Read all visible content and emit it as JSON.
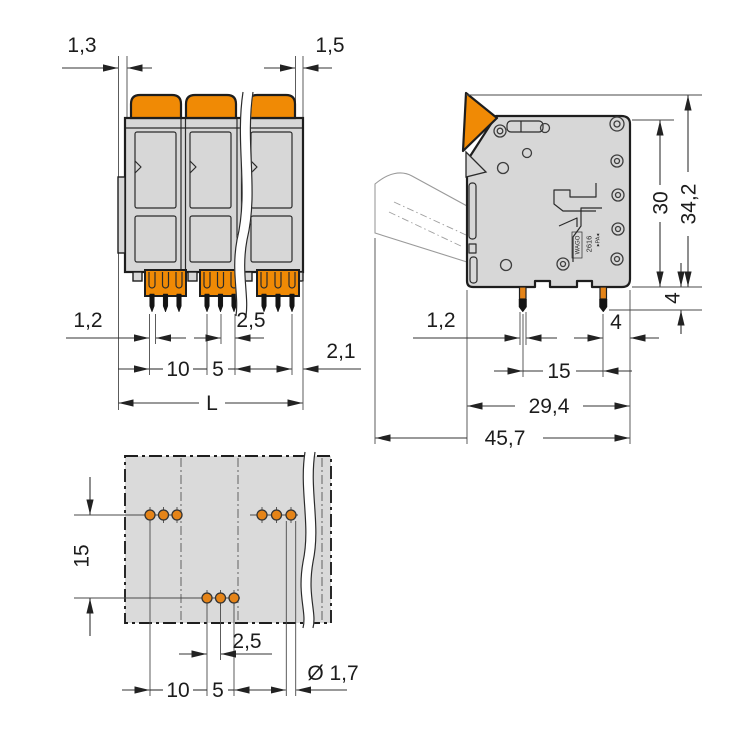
{
  "drawing_type": "terminal-block-dimension-drawing",
  "colors": {
    "orange": "#f08a05",
    "pad_orange": "#e58418",
    "body_grey": "#d7d7d7",
    "line": "#1e1e1e"
  },
  "front": {
    "d13": "1,3",
    "d15": "1,5",
    "d12": "1,2",
    "d25": "2,5",
    "d10": "10",
    "d5": "5",
    "d21": "2,1",
    "dL": "L"
  },
  "side": {
    "d30": "30",
    "d342": "34,2",
    "d4v": "4",
    "d12": "1,2",
    "d4h": "4",
    "d15": "15",
    "d294": "29,4",
    "d457": "45,7",
    "marking": {
      "brand": "WAGO",
      "series": "2616",
      "material": "▸PA◂"
    }
  },
  "footprint": {
    "d15": "15",
    "d25": "2,5",
    "d10": "10",
    "d5": "5",
    "ddia": "Ø 1,7"
  }
}
